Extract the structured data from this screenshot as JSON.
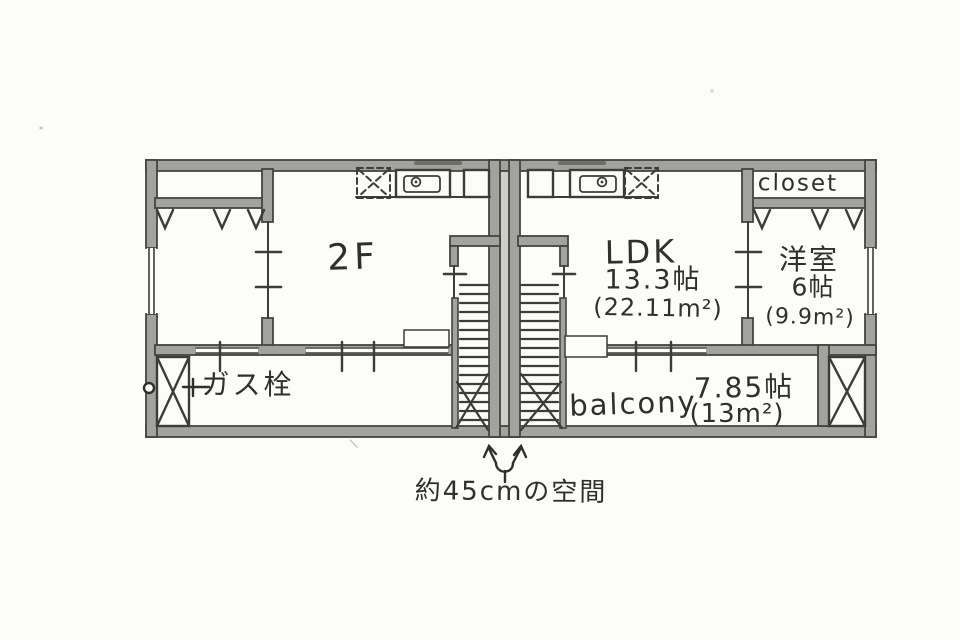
{
  "floor_plan": {
    "floor_label": "2F",
    "rooms": {
      "ldk": {
        "name": "LDK",
        "size_jo": "13.3帖",
        "size_m2": "(22.11m²)"
      },
      "western_room": {
        "name": "洋室",
        "size_jo": "6帖",
        "size_m2": "(9.9m²)"
      },
      "closet": {
        "name": "closet"
      },
      "balcony": {
        "name": "balcony",
        "size_jo": "7.85帖",
        "size_m2": "(13m²)"
      }
    },
    "fixtures": {
      "gas_tap_label": "ガス栓"
    },
    "annotations": {
      "gap_note": "約45cmの空間"
    }
  },
  "colors": {
    "wall_fill": "#a2a29e",
    "pencil_line": "#3c3c38",
    "gap_shade": "#cfcfca",
    "ink": "#2f2f2b",
    "paper": "#fcfcfa"
  }
}
